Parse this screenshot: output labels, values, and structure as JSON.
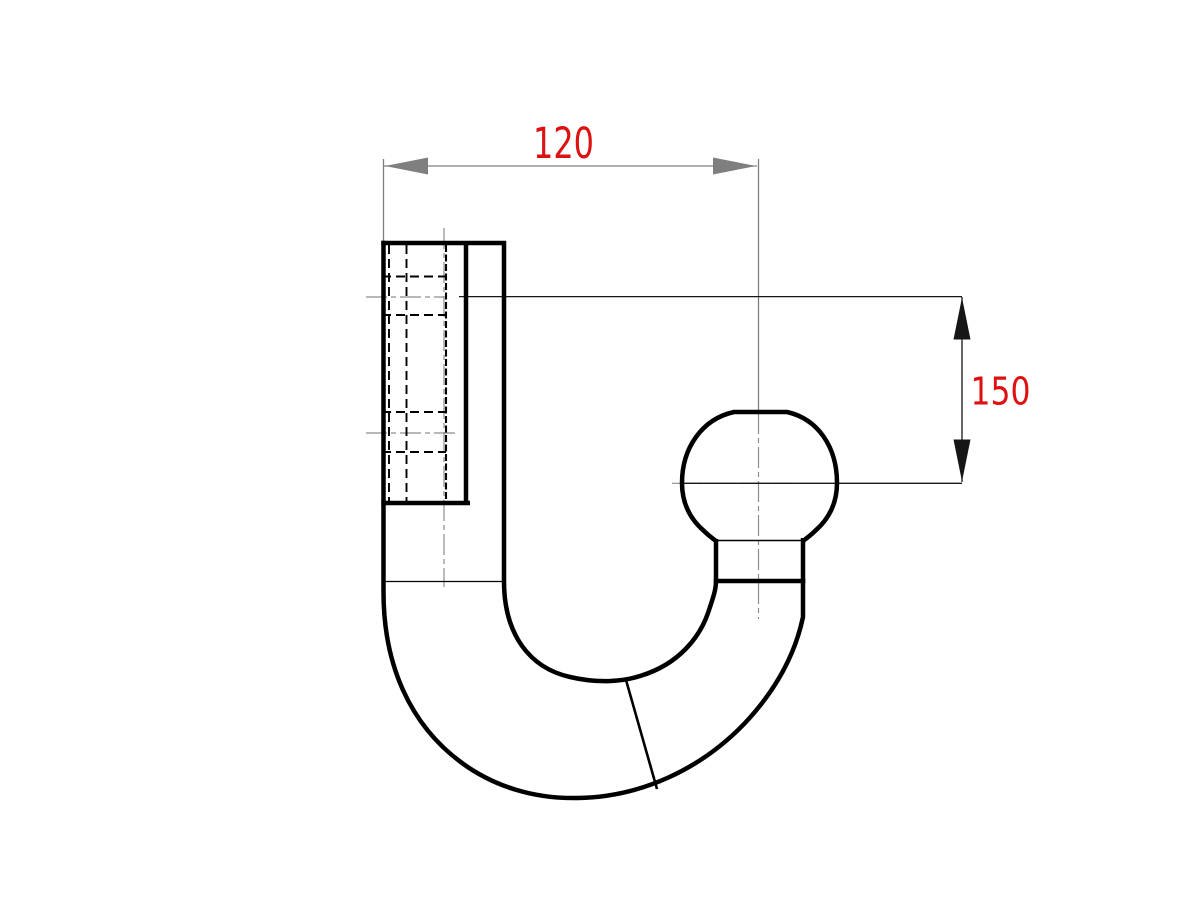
{
  "canvas": {
    "width": 1200,
    "height": 900,
    "background": "#ffffff"
  },
  "drawing": {
    "dimensions": {
      "horizontal": {
        "label": "120"
      },
      "vertical": {
        "label": "150"
      }
    },
    "colors": {
      "outline": "#000000",
      "hidden_line": "#000000",
      "centerline": "#8d8d8d",
      "dim_horizontal": "#7f7f7f",
      "dim_vertical": "#161616",
      "label": "#dd1111"
    }
  }
}
